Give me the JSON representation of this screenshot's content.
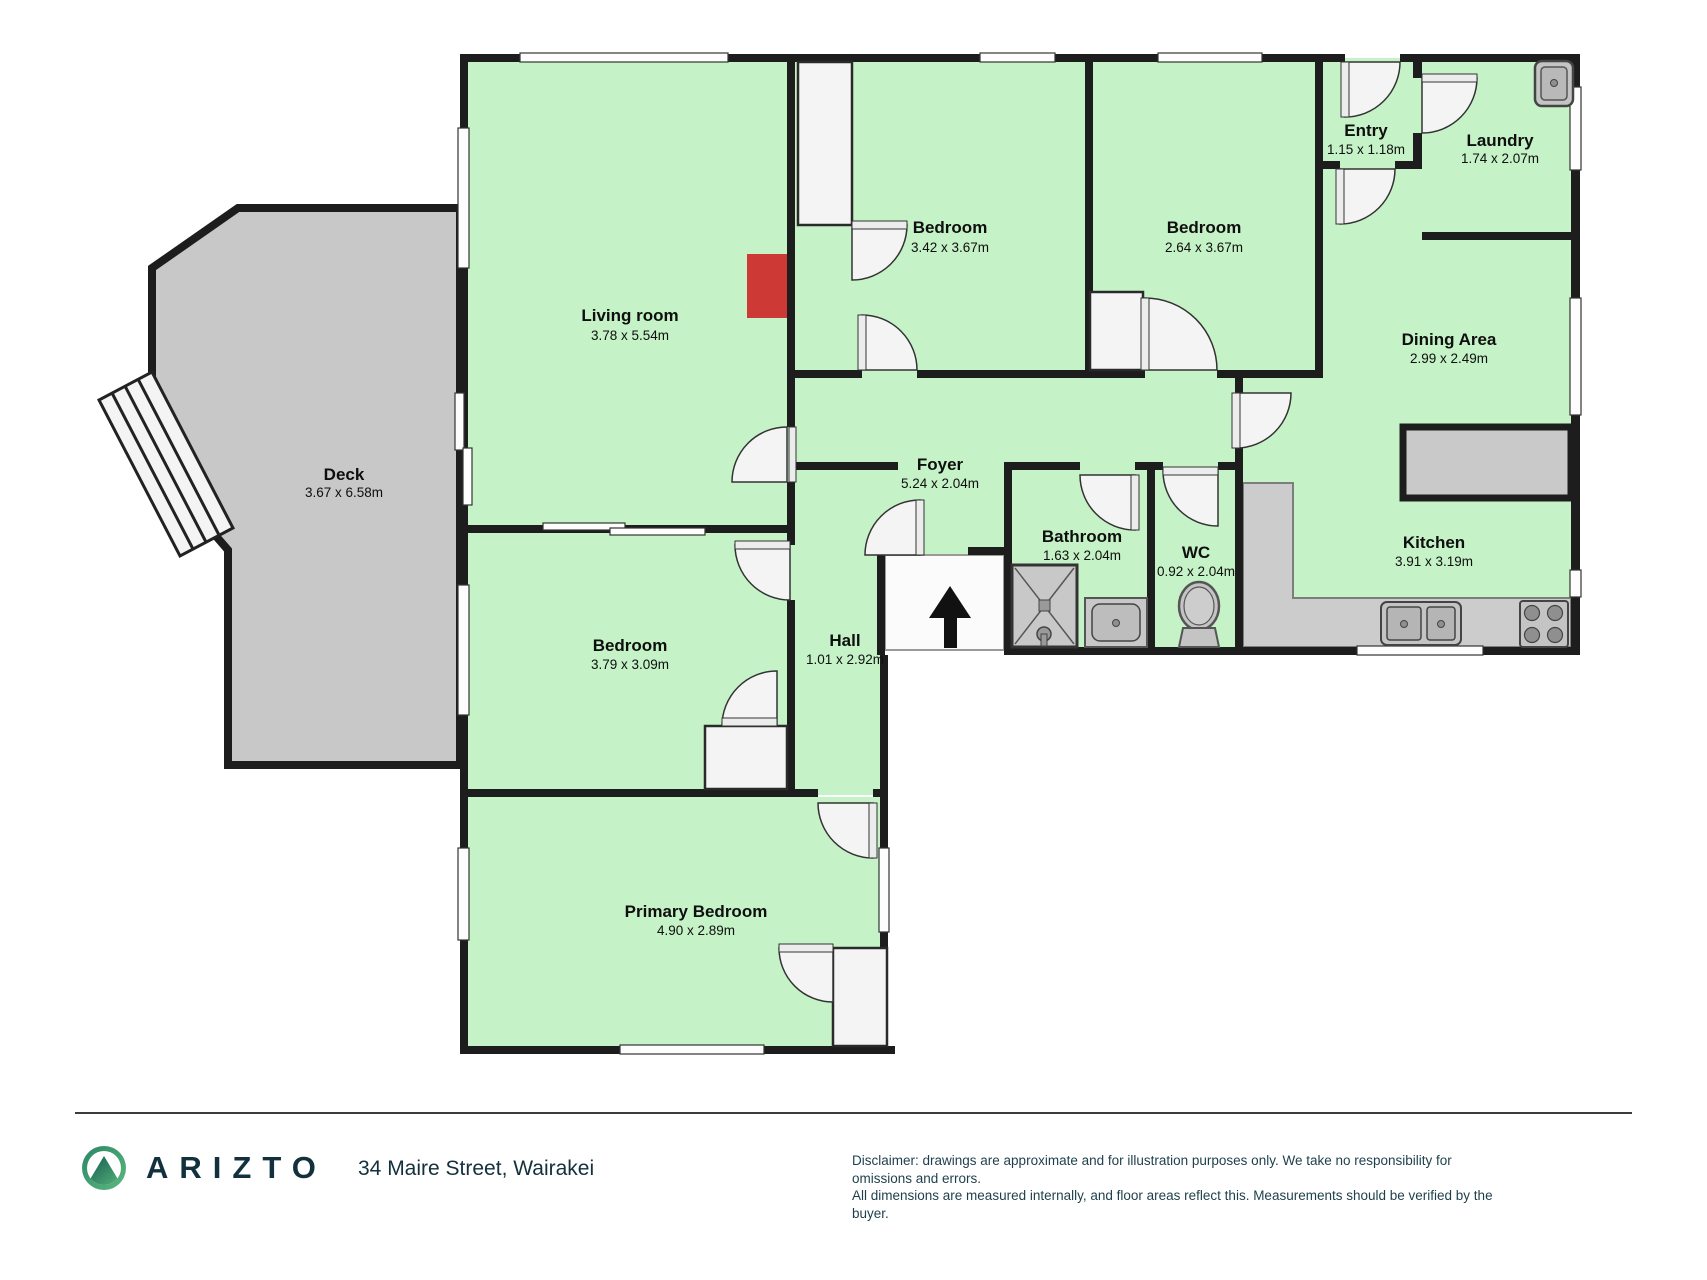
{
  "plan": {
    "rooms": {
      "living_room": {
        "name": "Living room",
        "dims": "3.78 x 5.54m"
      },
      "bedroom_1": {
        "name": "Bedroom",
        "dims": "3.42 x 3.67m"
      },
      "bedroom_2": {
        "name": "Bedroom",
        "dims": "2.64 x 3.67m"
      },
      "entry": {
        "name": "Entry",
        "dims": "1.15 x 1.18m"
      },
      "laundry": {
        "name": "Laundry",
        "dims": "1.74 x 2.07m"
      },
      "dining_area": {
        "name": "Dining Area",
        "dims": "2.99 x 2.49m"
      },
      "deck": {
        "name": "Deck",
        "dims": "3.67 x 6.58m"
      },
      "foyer": {
        "name": "Foyer",
        "dims": "5.24 x 2.04m"
      },
      "bathroom": {
        "name": "Bathroom",
        "dims": "1.63 x 2.04m"
      },
      "wc": {
        "name": "WC",
        "dims": "0.92 x 2.04m"
      },
      "kitchen": {
        "name": "Kitchen",
        "dims": "3.91 x 3.19m"
      },
      "bedroom_3": {
        "name": "Bedroom",
        "dims": "3.79 x 3.09m"
      },
      "hall": {
        "name": "Hall",
        "dims": "1.01 x 2.92m"
      },
      "primary_bedroom": {
        "name": "Primary Bedroom",
        "dims": "4.90 x 2.89m"
      }
    },
    "colors": {
      "room_fill": "#c5f2c6",
      "deck_fill": "#c8c8c8",
      "wall": "#1d1d1d",
      "fireplace_red": "#cd3a35",
      "door_window": "#f4f4f4",
      "fixture_gray": "#c4c4c4"
    }
  },
  "footer": {
    "brand": "ARIZTO",
    "address": "34 Maire Street, Wairakei",
    "disclaimer_line1": "Disclaimer: drawings are approximate and for illustration purposes only. We take no responsibility for omissions and errors.",
    "disclaimer_line2": "All dimensions are measured internally, and floor areas reflect this. Measurements should be verified by the buyer."
  }
}
